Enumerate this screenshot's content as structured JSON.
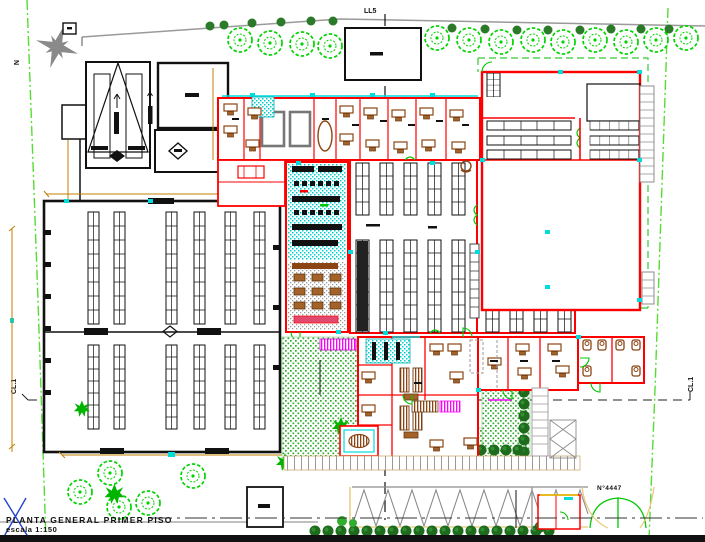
{
  "drawing": {
    "title": "PLANTA GENERAL PRIMER PISO",
    "scale": "escala 1:150",
    "north_label": "N",
    "axis_top_label": "LL5",
    "axis_left_label": "CL.1",
    "axis_right_label": "CL.1",
    "street_number": "N°4447"
  },
  "colors": {
    "wall_red": "#ff0000",
    "structure_black": "#111111",
    "vegetation_green": "#00d400",
    "hedge_dark_green": "#1e6b1e",
    "property_line_green": "#55dd33",
    "dimension_orange": "#c07f00",
    "accent_cyan": "#00dcdc",
    "accent_magenta": "#ff00ff",
    "furniture_brown": "#8b4513",
    "paving_gray": "#8c8c8c"
  }
}
